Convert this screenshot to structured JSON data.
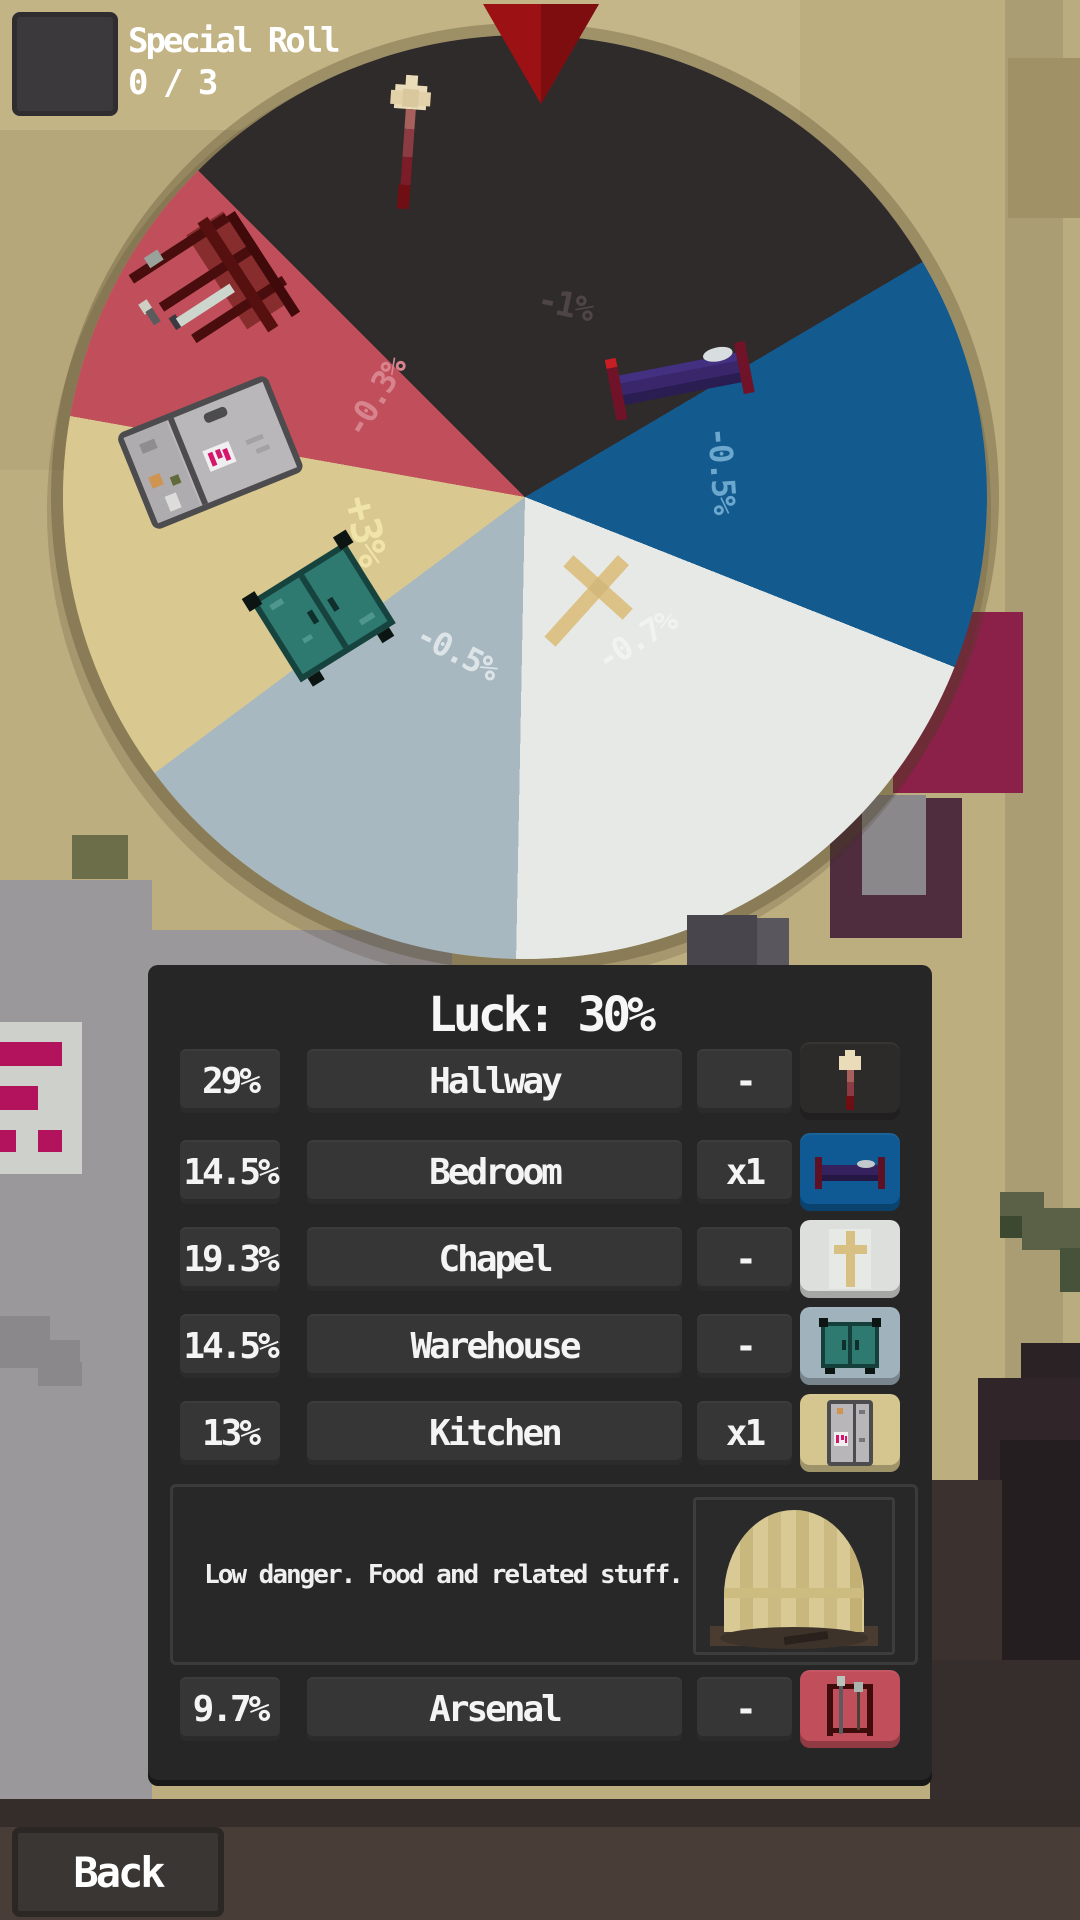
{
  "special_roll": {
    "label": "Special Roll",
    "count": "0 / 3"
  },
  "wheel": {
    "start_deg": -45,
    "segments": [
      {
        "name": "Hallway",
        "label": "-1%",
        "color": "#2f2b2b",
        "share_deg": 104.4,
        "icon": "torch-icon"
      },
      {
        "name": "Bedroom",
        "label": "-0.5%",
        "color": "#135a8f",
        "share_deg": 52.2,
        "icon": "bed-icon"
      },
      {
        "name": "Chapel",
        "label": "-0.7%",
        "color": "#e6e9e5",
        "share_deg": 69.5,
        "icon": "cross-icon"
      },
      {
        "name": "Warehouse",
        "label": "-0.5%",
        "color": "#a8b8c0",
        "share_deg": 52.2,
        "icon": "cabinet-icon"
      },
      {
        "name": "Kitchen",
        "label": "+3%",
        "color": "#d9c88f",
        "share_deg": 46.8,
        "icon": "fridge-icon"
      },
      {
        "name": "Arsenal",
        "label": "-0.3%",
        "color": "#c14f5b",
        "share_deg": 34.9,
        "icon": "weapon-rack-icon"
      }
    ],
    "label_colors": {
      "hallway": "#4d4546",
      "bedroom": "#6ca7cd",
      "chapel": "#f0f3ef",
      "warehouse": "#dce4e8",
      "kitchen": "#f0e4a8",
      "arsenal": "#d8848e"
    }
  },
  "panel": {
    "title": "Luck: 30%",
    "rows": [
      {
        "chance": "29%",
        "name": "Hallway",
        "mult": "-",
        "icon": "torch-icon"
      },
      {
        "chance": "14.5%",
        "name": "Bedroom",
        "mult": "x1",
        "icon": "bed-icon"
      },
      {
        "chance": "19.3%",
        "name": "Chapel",
        "mult": "-",
        "icon": "cross-icon"
      },
      {
        "chance": "14.5%",
        "name": "Warehouse",
        "mult": "-",
        "icon": "cabinet-icon"
      },
      {
        "chance": "13%",
        "name": "Kitchen",
        "mult": "x1",
        "icon": "fridge-icon"
      },
      {
        "chance": "9.7%",
        "name": "Arsenal",
        "mult": "-",
        "icon": "weapon-rack-icon"
      }
    ],
    "description": {
      "text": "Low danger. Food and related stuff.",
      "image": "striped-dome-tent"
    }
  },
  "back_button": {
    "label": "Back"
  }
}
